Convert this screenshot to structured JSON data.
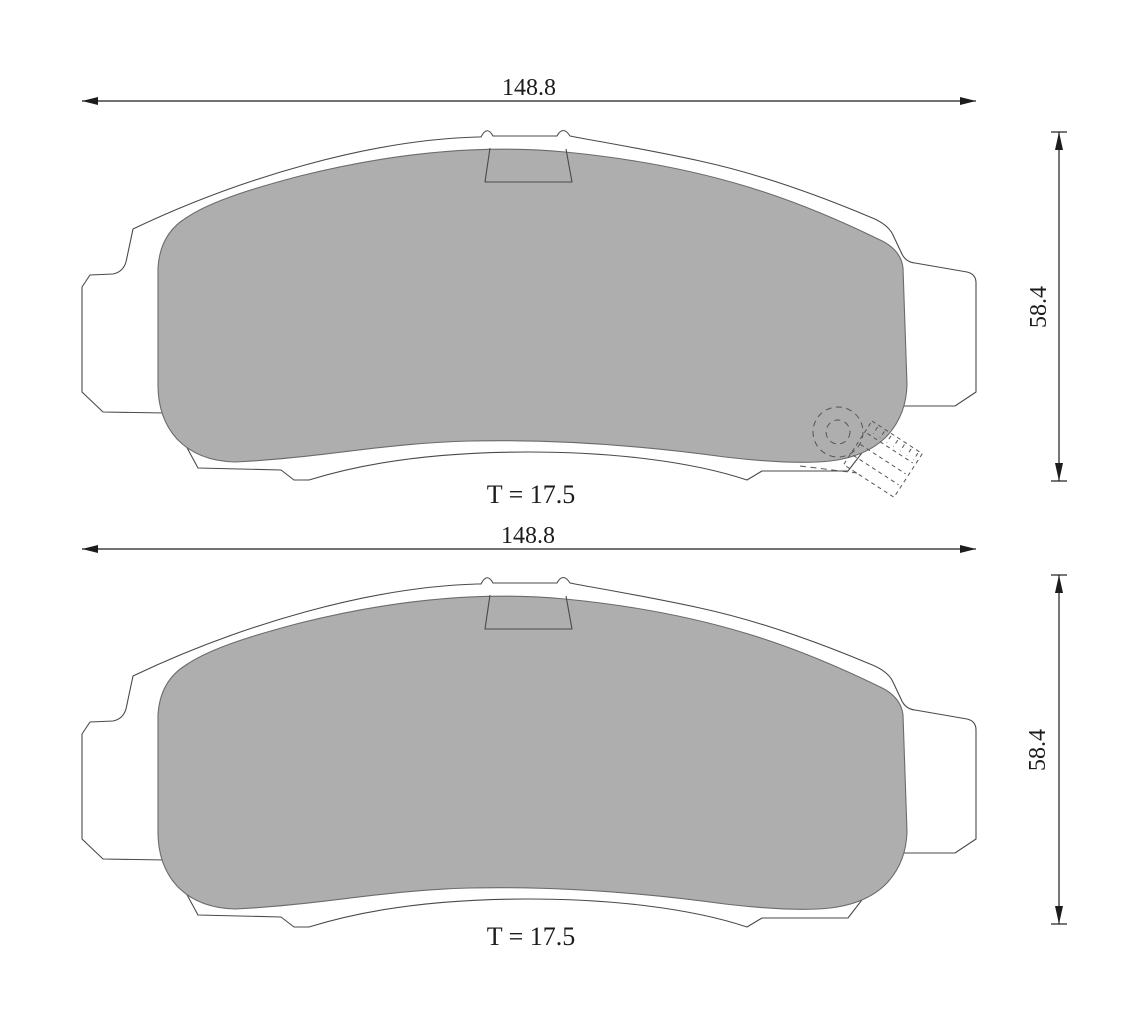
{
  "drawing": {
    "type": "brake-pad-technical-drawing",
    "views": [
      {
        "id": "top-view",
        "width_label": "148.8",
        "height_label": "58.4",
        "thickness_label": "T = 17.5",
        "has_wear_sensor": true
      },
      {
        "id": "bottom-view",
        "width_label": "148.8",
        "height_label": "58.4",
        "thickness_label": "T = 17.5",
        "has_wear_sensor": false
      }
    ],
    "colors": {
      "background": "#ffffff",
      "friction_material": "#aeaeae",
      "plate_outline": "#4a4a4a",
      "dimension": "#1c1c1c"
    }
  }
}
